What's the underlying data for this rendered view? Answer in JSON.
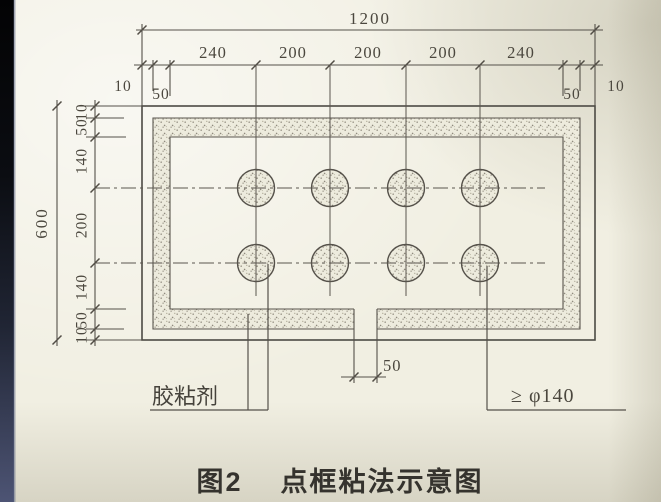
{
  "colors": {
    "ink": "#55514a",
    "paper": "#f1efe2",
    "left_edge_band": "#4d5474"
  },
  "dims": {
    "overall_width": "1200",
    "overall_height": "600",
    "top_segments": [
      "240",
      "200",
      "200",
      "200",
      "240"
    ],
    "top_left_edge": [
      "10",
      "50"
    ],
    "top_right_edge": [
      "50",
      "10"
    ],
    "left_segments": [
      "10",
      "50",
      "140",
      "200",
      "140",
      "50",
      "10"
    ],
    "bottom_gap": "50"
  },
  "labels": {
    "adhesive": "胶粘剂",
    "dot_spec": "≥ φ140"
  },
  "caption": {
    "figure_no": "图2",
    "title": "点框粘法示意图"
  }
}
